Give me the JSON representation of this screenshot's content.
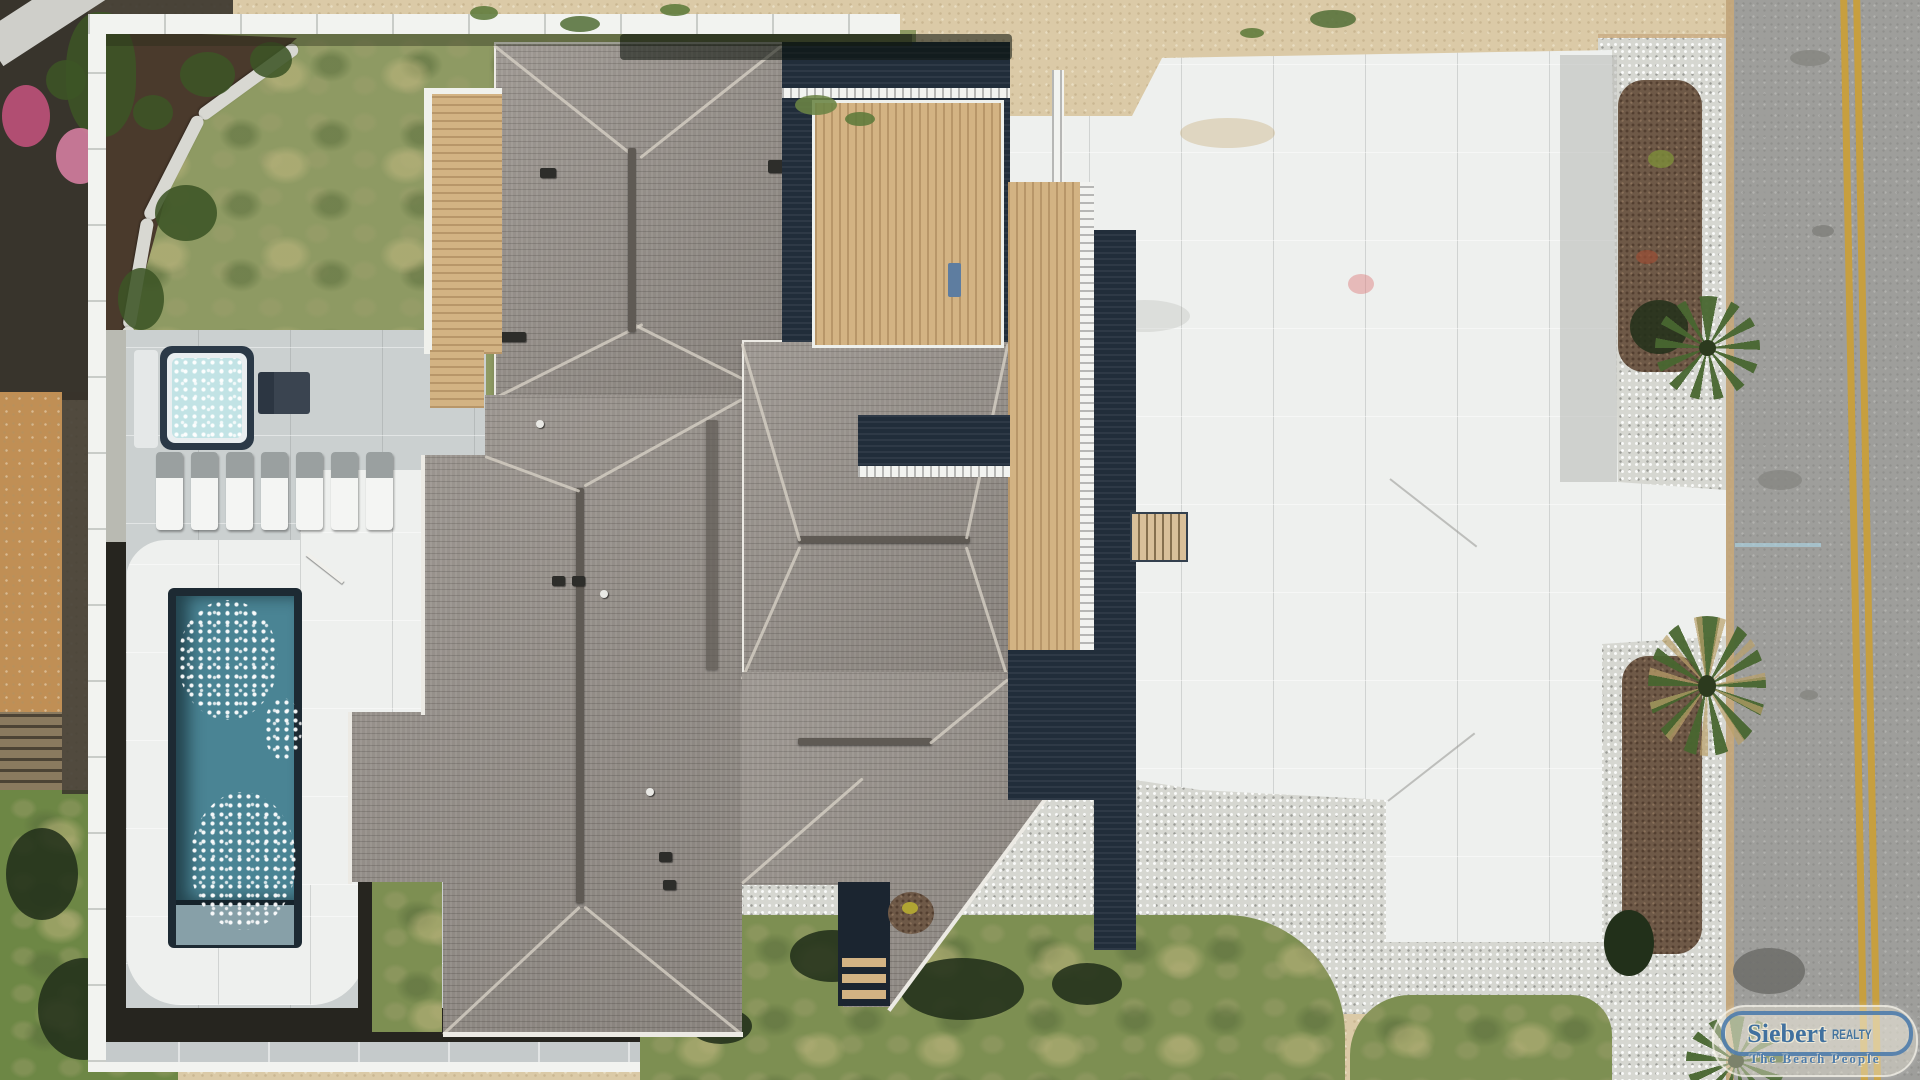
{
  "meta": {
    "title": "Aerial top-down drone photo of an oceanfront beach house",
    "view": "top-down aerial"
  },
  "watermark": {
    "brand": "Siebert",
    "brand_suffix": "REALTY",
    "tagline": "The Beach People",
    "pill_border_color": "#4e7cab",
    "text_color": "#41719f",
    "fill_color": "#efe9d8"
  },
  "scene": {
    "features": [
      "gray hip-roof shingled house",
      "rooftop ridge vents",
      "wood sun decks with white railings",
      "dark navy siding",
      "rectangular swimming pool",
      "hot tub",
      "row of lounge chairs",
      "white concrete pool patio",
      "white vinyl privacy fence",
      "mulch garden bed with shrubs",
      "stone landscape border",
      "patchy lawn",
      "white concrete driveway",
      "river-rock gravel strips",
      "mulch beds with palm trees",
      "asphalt road with double yellow line",
      "sand",
      "pink flowering bushes",
      "entry porch with wood steps",
      "exterior stairs to driveway"
    ],
    "counts": {
      "lounge_chairs": 7,
      "palm_trees": 4,
      "pools": 1,
      "hot_tubs": 1
    }
  },
  "palette": {
    "sand": "#dbcaa7",
    "road": "#9e9e9b",
    "roadLine": "#c79f3f",
    "roadEdge": "#c9a878",
    "gravel": "#d6d7d1",
    "mulchBed": "#6e5947",
    "gardenMulch": "#4a3a2c",
    "lawn": "#8e9a63",
    "grassBright": "#6d8745",
    "grassOlive": "#7d8f52",
    "roofShingle": "#96908a",
    "ridgeDark": "#5f5a54",
    "fasciaWhite": "#eceae4",
    "deckWood": "#d3b383",
    "navySiding": "#212d3a",
    "concrete": "#cbd0d0",
    "patioWhite": "#eef0ee",
    "walkwayGray": "#c5cacb",
    "fenceWhite": "#f2f3f0",
    "pathTan": "#c08f55",
    "poolWater": "#4a8494",
    "poolStep": "#87a0a8",
    "hotTubWater": "#c2e3e5",
    "tubShell": "#2b3947",
    "mulchBorder": "#26251f",
    "flowerPink": "#c2527c",
    "flowerPinkLight": "#d77fa3",
    "shrubGreen": "#3c5426",
    "palmShadow": "#22301a",
    "stoneBorder": "#d8d8d2",
    "loungeWhite": "#f4f5f3",
    "loungeGray": "#9aa0a0",
    "boardwalk": "#8a7a5f",
    "darkOutside": "#38342c",
    "porchNavy": "#1b2530"
  }
}
